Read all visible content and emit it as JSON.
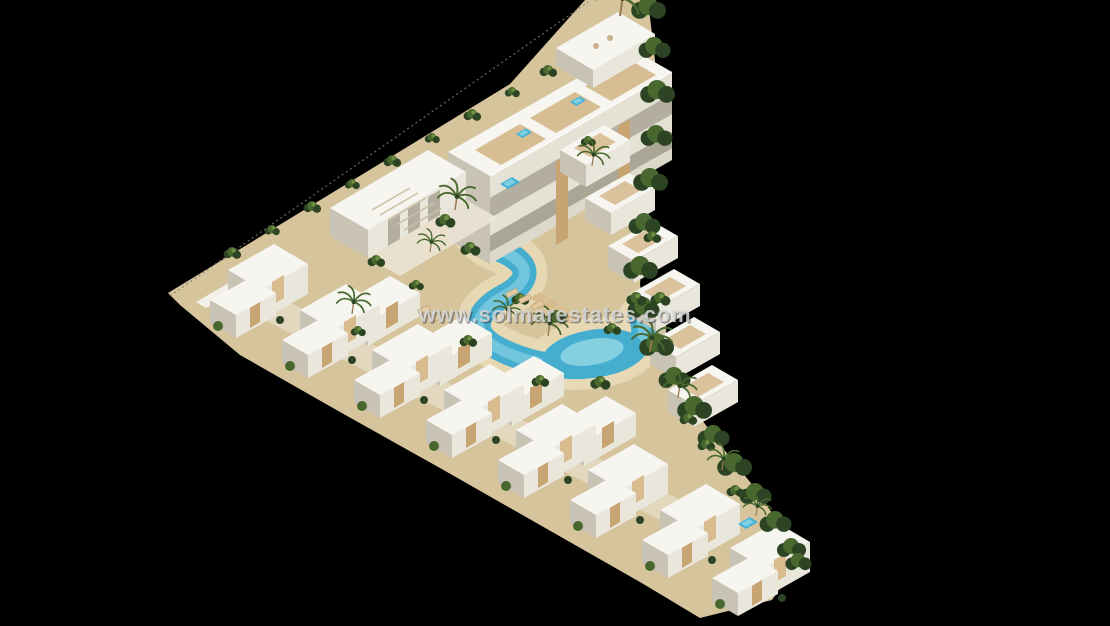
{
  "watermark": {
    "text": "www.solmarestates.com"
  },
  "palette": {
    "background": "#000000",
    "building_white": "#f6f5f0",
    "building_shadow": "#c8c3b4",
    "wood_accent": "#c8a472",
    "sand": "#d6c49c",
    "pool": "#45aecf",
    "pool_light": "#85d0e0",
    "vegetation_dark": "#2c4423",
    "vegetation_mid": "#48682f",
    "watermark": "#d8d8d8"
  },
  "scene": {
    "instances": [
      {
        "id": "back-unit",
        "x": 338,
        "y": 306
      },
      {
        "id": "back-unit",
        "x": 410,
        "y": 346
      },
      {
        "id": "back-unit",
        "x": 482,
        "y": 386
      },
      {
        "id": "back-unit",
        "x": 554,
        "y": 426
      },
      {
        "id": "villa",
        "x": 210,
        "y": 300
      },
      {
        "id": "villa",
        "x": 282,
        "y": 340
      },
      {
        "id": "villa",
        "x": 354,
        "y": 380
      },
      {
        "id": "villa",
        "x": 426,
        "y": 420
      },
      {
        "id": "villa",
        "x": 498,
        "y": 460
      },
      {
        "id": "villa",
        "x": 570,
        "y": 500
      },
      {
        "id": "villa",
        "x": 642,
        "y": 540
      },
      {
        "id": "villa",
        "x": 712,
        "y": 578
      },
      {
        "id": "terrace-unit",
        "x": 560,
        "y": 150
      },
      {
        "id": "terrace-unit",
        "x": 585,
        "y": 198
      },
      {
        "id": "terrace-unit",
        "x": 608,
        "y": 246
      },
      {
        "id": "terrace-unit",
        "x": 630,
        "y": 294
      },
      {
        "id": "terrace-unit",
        "x": 650,
        "y": 342
      },
      {
        "id": "terrace-unit",
        "x": 668,
        "y": 390
      },
      {
        "id": "hedge-bush",
        "x": 648,
        "y": 8,
        "s": 1.2
      },
      {
        "id": "hedge-bush",
        "x": 654,
        "y": 48,
        "s": 1.1
      },
      {
        "id": "hedge-bush",
        "x": 657,
        "y": 92,
        "s": 1.2
      },
      {
        "id": "hedge-bush",
        "x": 656,
        "y": 136,
        "s": 1.1
      },
      {
        "id": "hedge-bush",
        "x": 650,
        "y": 180,
        "s": 1.2
      },
      {
        "id": "hedge-bush",
        "x": 644,
        "y": 224,
        "s": 1.1
      },
      {
        "id": "hedge-bush",
        "x": 640,
        "y": 268,
        "s": 1.2
      },
      {
        "id": "hedge-bush",
        "x": 643,
        "y": 308,
        "s": 1.1
      },
      {
        "id": "hedge-bush",
        "x": 656,
        "y": 345,
        "s": 1.2
      },
      {
        "id": "hedge-bush",
        "x": 674,
        "y": 378,
        "s": 1.1
      },
      {
        "id": "hedge-bush",
        "x": 694,
        "y": 408,
        "s": 1.2
      },
      {
        "id": "hedge-bush",
        "x": 713,
        "y": 436,
        "s": 1.1
      },
      {
        "id": "hedge-bush",
        "x": 734,
        "y": 465,
        "s": 1.2
      },
      {
        "id": "hedge-bush",
        "x": 755,
        "y": 494,
        "s": 1.1
      },
      {
        "id": "hedge-bush",
        "x": 775,
        "y": 522,
        "s": 1.1
      },
      {
        "id": "hedge-bush",
        "x": 791,
        "y": 548,
        "s": 1.0
      },
      {
        "id": "hedge-bush",
        "x": 798,
        "y": 562,
        "s": 0.9
      },
      {
        "id": "bush",
        "x": 232,
        "y": 254,
        "s": 0.7
      },
      {
        "id": "bush",
        "x": 272,
        "y": 231,
        "s": 0.6
      },
      {
        "id": "bush",
        "x": 312,
        "y": 208,
        "s": 0.7
      },
      {
        "id": "bush",
        "x": 352,
        "y": 185,
        "s": 0.6
      },
      {
        "id": "bush",
        "x": 392,
        "y": 162,
        "s": 0.7
      },
      {
        "id": "bush",
        "x": 432,
        "y": 139,
        "s": 0.6
      },
      {
        "id": "bush",
        "x": 472,
        "y": 116,
        "s": 0.7
      },
      {
        "id": "bush",
        "x": 512,
        "y": 93,
        "s": 0.6
      },
      {
        "id": "bush",
        "x": 548,
        "y": 72,
        "s": 0.7
      },
      {
        "id": "bush",
        "x": 470,
        "y": 250,
        "s": 0.8
      },
      {
        "id": "bush",
        "x": 520,
        "y": 300,
        "s": 0.7
      },
      {
        "id": "bush",
        "x": 556,
        "y": 318,
        "s": 0.8
      },
      {
        "id": "bush",
        "x": 612,
        "y": 330,
        "s": 0.7
      },
      {
        "id": "bush",
        "x": 636,
        "y": 300,
        "s": 0.8
      },
      {
        "id": "bush",
        "x": 600,
        "y": 384,
        "s": 0.8
      },
      {
        "id": "bush",
        "x": 540,
        "y": 382,
        "s": 0.7
      },
      {
        "id": "bush",
        "x": 468,
        "y": 342,
        "s": 0.7
      },
      {
        "id": "bush",
        "x": 445,
        "y": 222,
        "s": 0.8
      },
      {
        "id": "bush",
        "x": 376,
        "y": 262,
        "s": 0.7
      },
      {
        "id": "bush",
        "x": 588,
        "y": 142,
        "s": 0.6
      },
      {
        "id": "bush",
        "x": 652,
        "y": 238,
        "s": 0.7
      },
      {
        "id": "bush",
        "x": 660,
        "y": 300,
        "s": 0.8
      },
      {
        "id": "bush",
        "x": 688,
        "y": 420,
        "s": 0.7
      },
      {
        "id": "bush",
        "x": 706,
        "y": 446,
        "s": 0.7
      },
      {
        "id": "bush",
        "x": 735,
        "y": 492,
        "s": 0.7
      },
      {
        "id": "bush",
        "x": 416,
        "y": 286,
        "s": 0.6
      },
      {
        "id": "bush",
        "x": 358,
        "y": 332,
        "s": 0.6
      },
      {
        "id": "palm",
        "x": 620,
        "y": 16,
        "s": 1.3
      },
      {
        "id": "palm",
        "x": 455,
        "y": 210,
        "s": 0.95
      },
      {
        "id": "palm",
        "x": 352,
        "y": 314,
        "s": 0.85
      },
      {
        "id": "palm",
        "x": 548,
        "y": 336,
        "s": 0.9
      },
      {
        "id": "palm",
        "x": 650,
        "y": 352,
        "s": 1
      },
      {
        "id": "palm",
        "x": 678,
        "y": 398,
        "s": 0.85
      },
      {
        "id": "palm",
        "x": 592,
        "y": 166,
        "s": 0.8
      },
      {
        "id": "palm",
        "x": 430,
        "y": 252,
        "s": 0.7
      },
      {
        "id": "palm",
        "x": 506,
        "y": 320,
        "s": 0.75
      },
      {
        "id": "palm",
        "x": 722,
        "y": 470,
        "s": 0.8
      },
      {
        "id": "palm",
        "x": 756,
        "y": 516,
        "s": 0.7
      },
      {
        "id": "lounger",
        "x": 512,
        "y": 293,
        "r": -25
      },
      {
        "id": "lounger",
        "x": 525,
        "y": 299,
        "r": -25
      },
      {
        "id": "lounger",
        "x": 538,
        "y": 305,
        "r": -25
      },
      {
        "id": "lounger",
        "x": 424,
        "y": 310,
        "r": -25
      },
      {
        "id": "lounger",
        "x": 438,
        "y": 317,
        "r": -25
      },
      {
        "id": "plunge-pool",
        "x": 500,
        "y": 184
      },
      {
        "id": "plunge-pool",
        "x": 738,
        "y": 524
      },
      {
        "id": "plunge-pool",
        "x": 516,
        "y": 134,
        "s": 0.8
      },
      {
        "id": "plunge-pool",
        "x": 570,
        "y": 102,
        "s": 0.8
      }
    ]
  }
}
